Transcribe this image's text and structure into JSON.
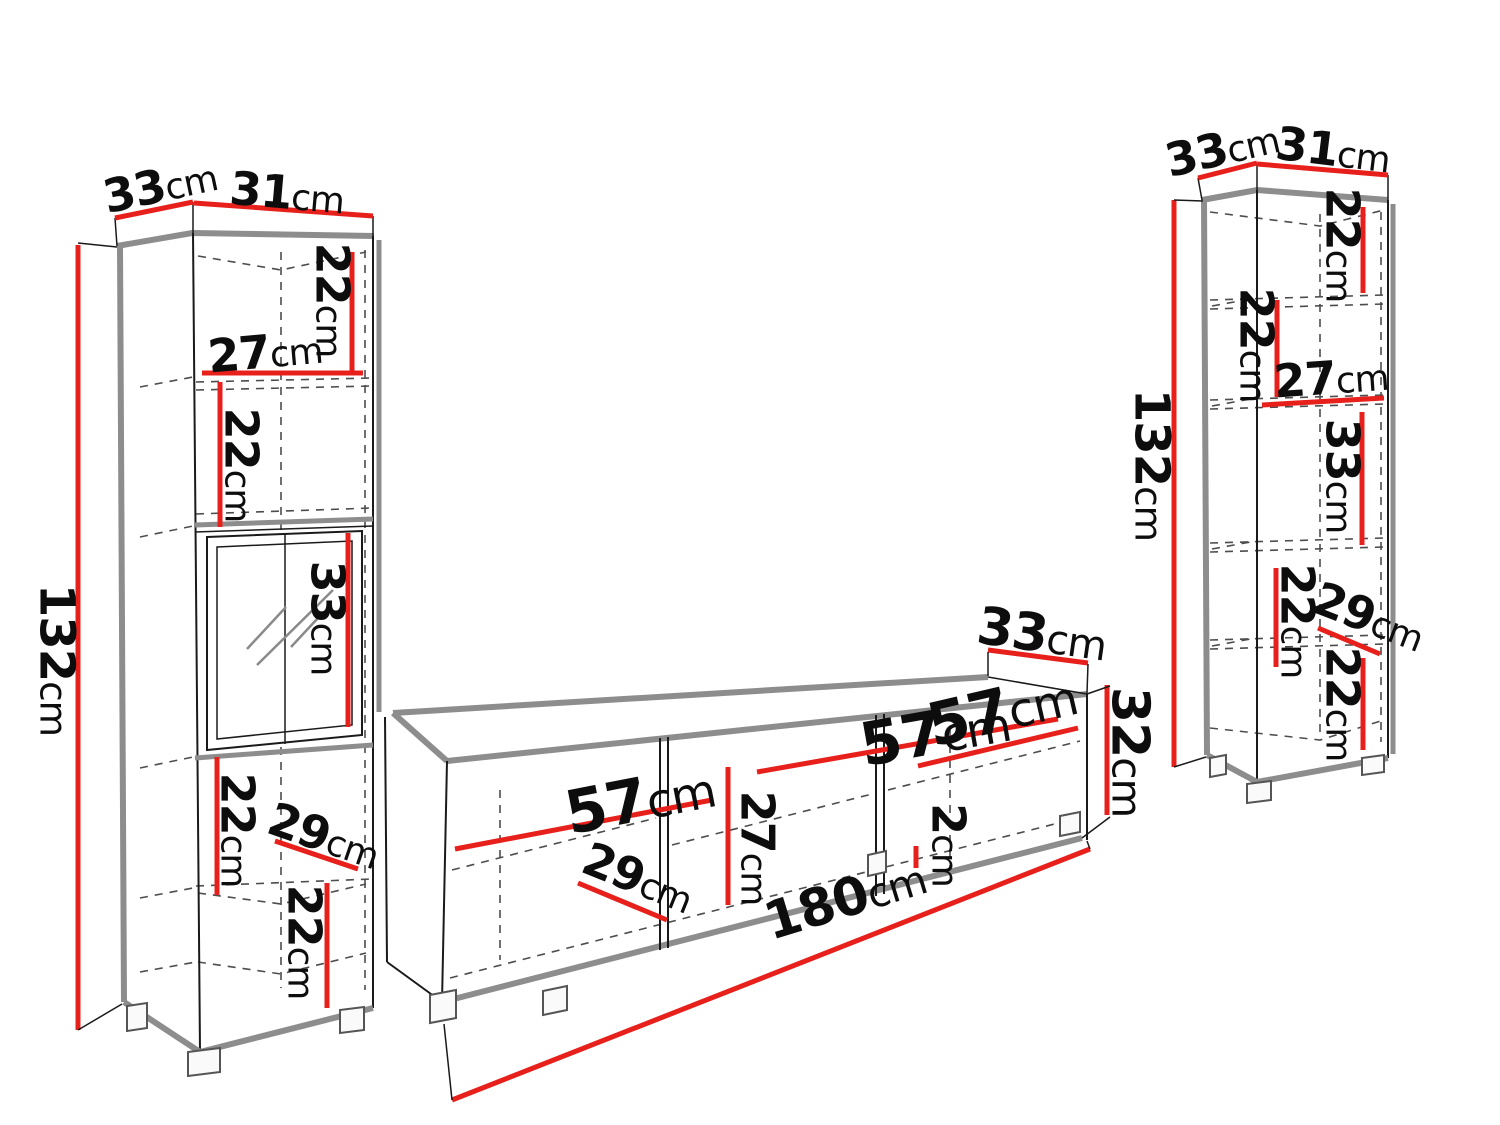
{
  "diagram_title": "Wall unit furniture dimensions diagram",
  "unit_system": "cm",
  "colors": {
    "dimension_red": "#e8201c",
    "carcass_gray": "#8d8d8d",
    "line_black": "#1a1a1a",
    "background": "#ffffff"
  },
  "left_cabinet": {
    "name": "Tall display cabinet (left)",
    "dims": {
      "depth_top": {
        "value": "33",
        "unit": "cm"
      },
      "width_top": {
        "value": "31",
        "unit": "cm"
      },
      "height_total": {
        "value": "132",
        "unit": "cm"
      },
      "section1_height": {
        "value": "22",
        "unit": "cm"
      },
      "section1_width": {
        "value": "27",
        "unit": "cm"
      },
      "section2_height": {
        "value": "22",
        "unit": "cm"
      },
      "glass_section_height": {
        "value": "33",
        "unit": "cm"
      },
      "section4_height": {
        "value": "22",
        "unit": "cm"
      },
      "shelf_depth": {
        "value": "29",
        "unit": "cm"
      },
      "section5_height": {
        "value": "22",
        "unit": "cm"
      }
    }
  },
  "tv_stand": {
    "name": "TV stand (center)",
    "dims": {
      "depth_top": {
        "value": "33",
        "unit": "cm"
      },
      "compartment1_width": {
        "value": "57",
        "unit": "cm"
      },
      "compartment2_width": {
        "value": "57",
        "unit": "cm"
      },
      "compartment3_width": {
        "value": "57",
        "unit": "cm"
      },
      "inner_height": {
        "value": "27",
        "unit": "cm"
      },
      "shelf_depth": {
        "value": "29",
        "unit": "cm"
      },
      "panel_gap": {
        "value": "2",
        "unit": "cm"
      },
      "height": {
        "value": "32",
        "unit": "cm"
      },
      "total_width": {
        "value": "180",
        "unit": "cm"
      }
    }
  },
  "right_cabinet": {
    "name": "Tall cabinet (right)",
    "dims": {
      "depth_top": {
        "value": "33",
        "unit": "cm"
      },
      "width_top": {
        "value": "31",
        "unit": "cm"
      },
      "height_total": {
        "value": "132",
        "unit": "cm"
      },
      "section1_height": {
        "value": "22",
        "unit": "cm"
      },
      "section2_height": {
        "value": "22",
        "unit": "cm"
      },
      "section2_width": {
        "value": "27",
        "unit": "cm"
      },
      "section3_height": {
        "value": "33",
        "unit": "cm"
      },
      "section4_height": {
        "value": "22",
        "unit": "cm"
      },
      "shelf_depth": {
        "value": "29",
        "unit": "cm"
      },
      "section5_height": {
        "value": "22",
        "unit": "cm"
      }
    }
  }
}
